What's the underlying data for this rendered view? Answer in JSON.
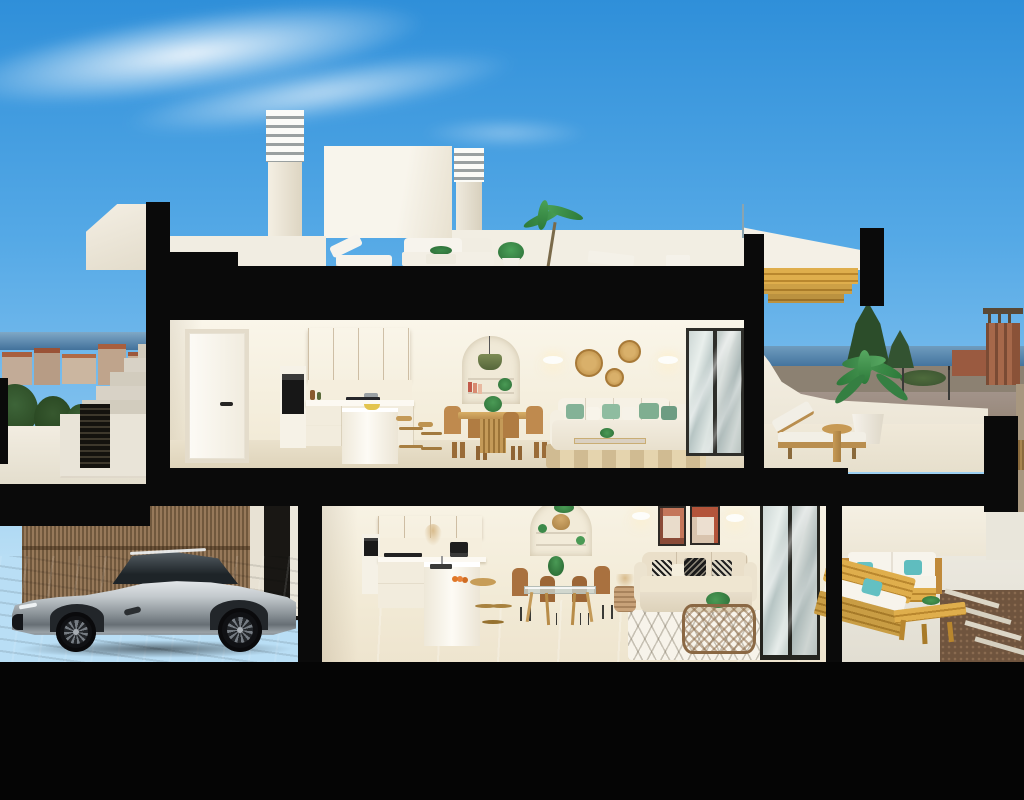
{
  "image": {
    "kind": "3d-architectural-cross-section-render",
    "description": "Cutaway elevation render of a two-storey Mediterranean townhouse: roof terrace with chimneys and outdoor lounge, furnished upper and ground floors (kitchen, dining, living, terraces), exterior stair, reed fence and a silver sports coupe parked on the driveway, coastal town and sea in the background under a blue sky",
    "width_px": 1024,
    "height_px": 800,
    "visible_text": "none"
  },
  "palette": {
    "sky_top": "#2f8fd9",
    "sky_horizon": "#b9def5",
    "cloud": "#ffffff",
    "cut_poche_black": "#0a0a0a",
    "wall_cream": "#f6f0e2",
    "wall_shadow": "#e7dcc6",
    "floor_beige": "#e6dcc8",
    "wood_cabinet": "#d9b271",
    "wood_furniture": "#c08b4a",
    "pergola_gold": "#d7a33f",
    "plant_green": "#3c8a4a",
    "sofa_cream": "#efe9da",
    "pillow_green": "#84b297",
    "pillow_turquoise": "#66c2c4",
    "art_terracotta": "#c4765a",
    "sea": "#44749e",
    "town_roof": "#a85f3e",
    "road": "#a3948a",
    "dirt": "#8c8172",
    "driveway_pavers": "#9aa0a2",
    "car_silver": "#c3c9cd",
    "reed_fence": "#97795a",
    "tower_brick": "#a6684a"
  },
  "levels": {
    "roof": {
      "label": "Roof terrace",
      "items": [
        "louvered-chimney-left",
        "louvered-chimney-right",
        "stair-bulkhead",
        "roof-box",
        "white-outdoor-sofa",
        "sun-lounger",
        "flat-lounger",
        "potted-palm",
        "planter-pot",
        "parapet"
      ]
    },
    "upper_floor": {
      "label": "Upper floor",
      "kitchen": [
        "white-door",
        "oak-upper-cabinets",
        "oven-column",
        "cooktop",
        "white-base-cabinets",
        "island",
        "two-wood-stools",
        "counter-props"
      ],
      "living_dining": [
        "arched-niche-shelves",
        "green-pendant-lamp",
        "wood-dining-table",
        "four-wood-chairs",
        "wall-sconces",
        "three-rattan-wall-plates",
        "cream-sofa-green-pillows",
        "glass-coffee-table",
        "jute-rug",
        "sliding-glass-door"
      ],
      "terrace": [
        "curved-parapet",
        "wood-sun-lounger",
        "round-side-table",
        "large-potted-palm",
        "wood-slat-pergola-soffit"
      ]
    },
    "ground_floor": {
      "label": "Ground floor",
      "kitchen": [
        "oak-upper-cabinets",
        "oven-column",
        "cooktop",
        "peninsula-with-sink",
        "fruit-bowl",
        "coffee-machine",
        "pampas-vase",
        "wood-stool"
      ],
      "living_dining": [
        "arched-niche-shelves",
        "rattan-pendant",
        "glass-dining-table",
        "four-brown-chairs",
        "two-abstract-artworks",
        "wall-sconces",
        "beige-sofa-patterned-pillows",
        "wicker-coffee-table",
        "diamond-pattern-rug",
        "basket-with-pampas",
        "sliding-glass-door"
      ],
      "terrace": [
        "wood-outdoor-sofa-set",
        "turquoise-pillows",
        "wood-bench-table",
        "planter",
        "gravel-bed-with-step-planks",
        "reed-fence"
      ]
    },
    "exterior": {
      "label": "Street level",
      "items": [
        "external-staircase",
        "louvered-gate",
        "boundary-wall",
        "reed-privacy-fence",
        "paved-driveway",
        "silver-sports-coupe"
      ]
    },
    "background": {
      "label": "Backdrop",
      "items": [
        "wispy-clouds",
        "coastal-town-rooftops",
        "sea-strip",
        "dark-trees",
        "watchtower",
        "red-building",
        "street-lamps",
        "road"
      ]
    }
  }
}
